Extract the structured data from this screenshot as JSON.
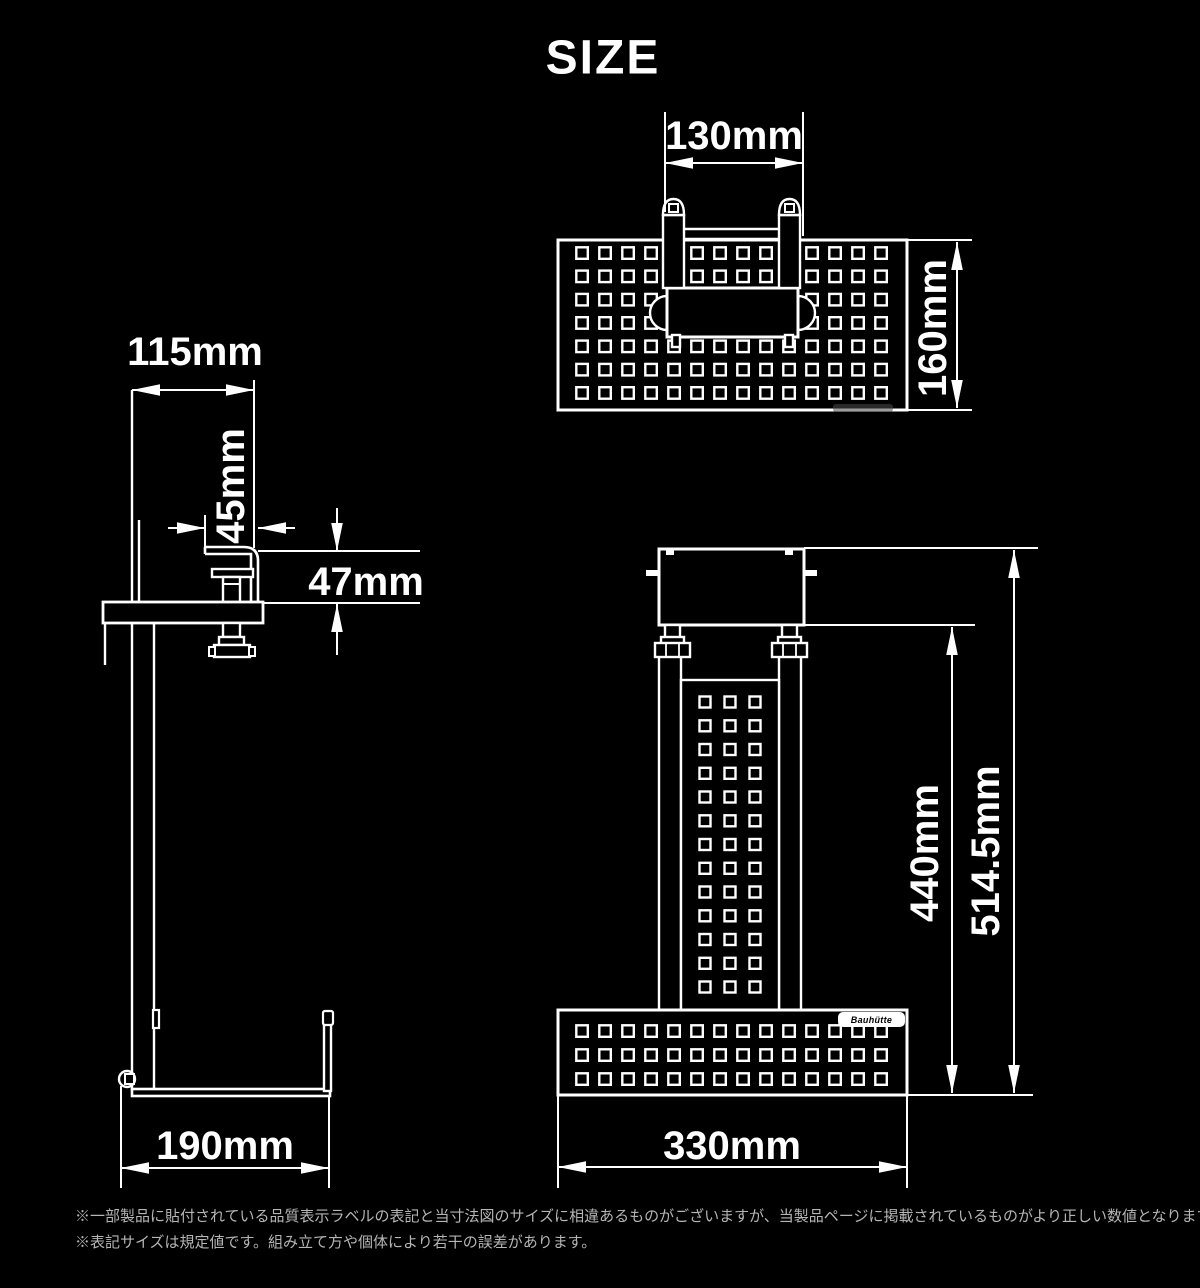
{
  "title": "SIZE",
  "dimensions": {
    "top_view": {
      "clamp_width": "130mm",
      "plate_depth": "160mm"
    },
    "side_view": {
      "top_depth": "115mm",
      "clamp_plate_depth": "45mm",
      "clamp_opening": "47mm",
      "base_depth": "190mm"
    },
    "front_view": {
      "column_height": "440mm",
      "total_height": "514.5mm",
      "base_width": "330mm"
    }
  },
  "logo_badge": "Bauhütte",
  "notes": [
    "※一部製品に貼付されている品質表示ラベルの表記と当寸法図のサイズに相違あるものがございますが、当製品ページに掲載されているものがより正しい数値となります。",
    "※表記サイズは規定値です。組み立て方や個体により若干の誤差があります。"
  ],
  "colors": {
    "background": "#000000",
    "line": "#ffffff",
    "note_text": "#b5b5b5"
  }
}
